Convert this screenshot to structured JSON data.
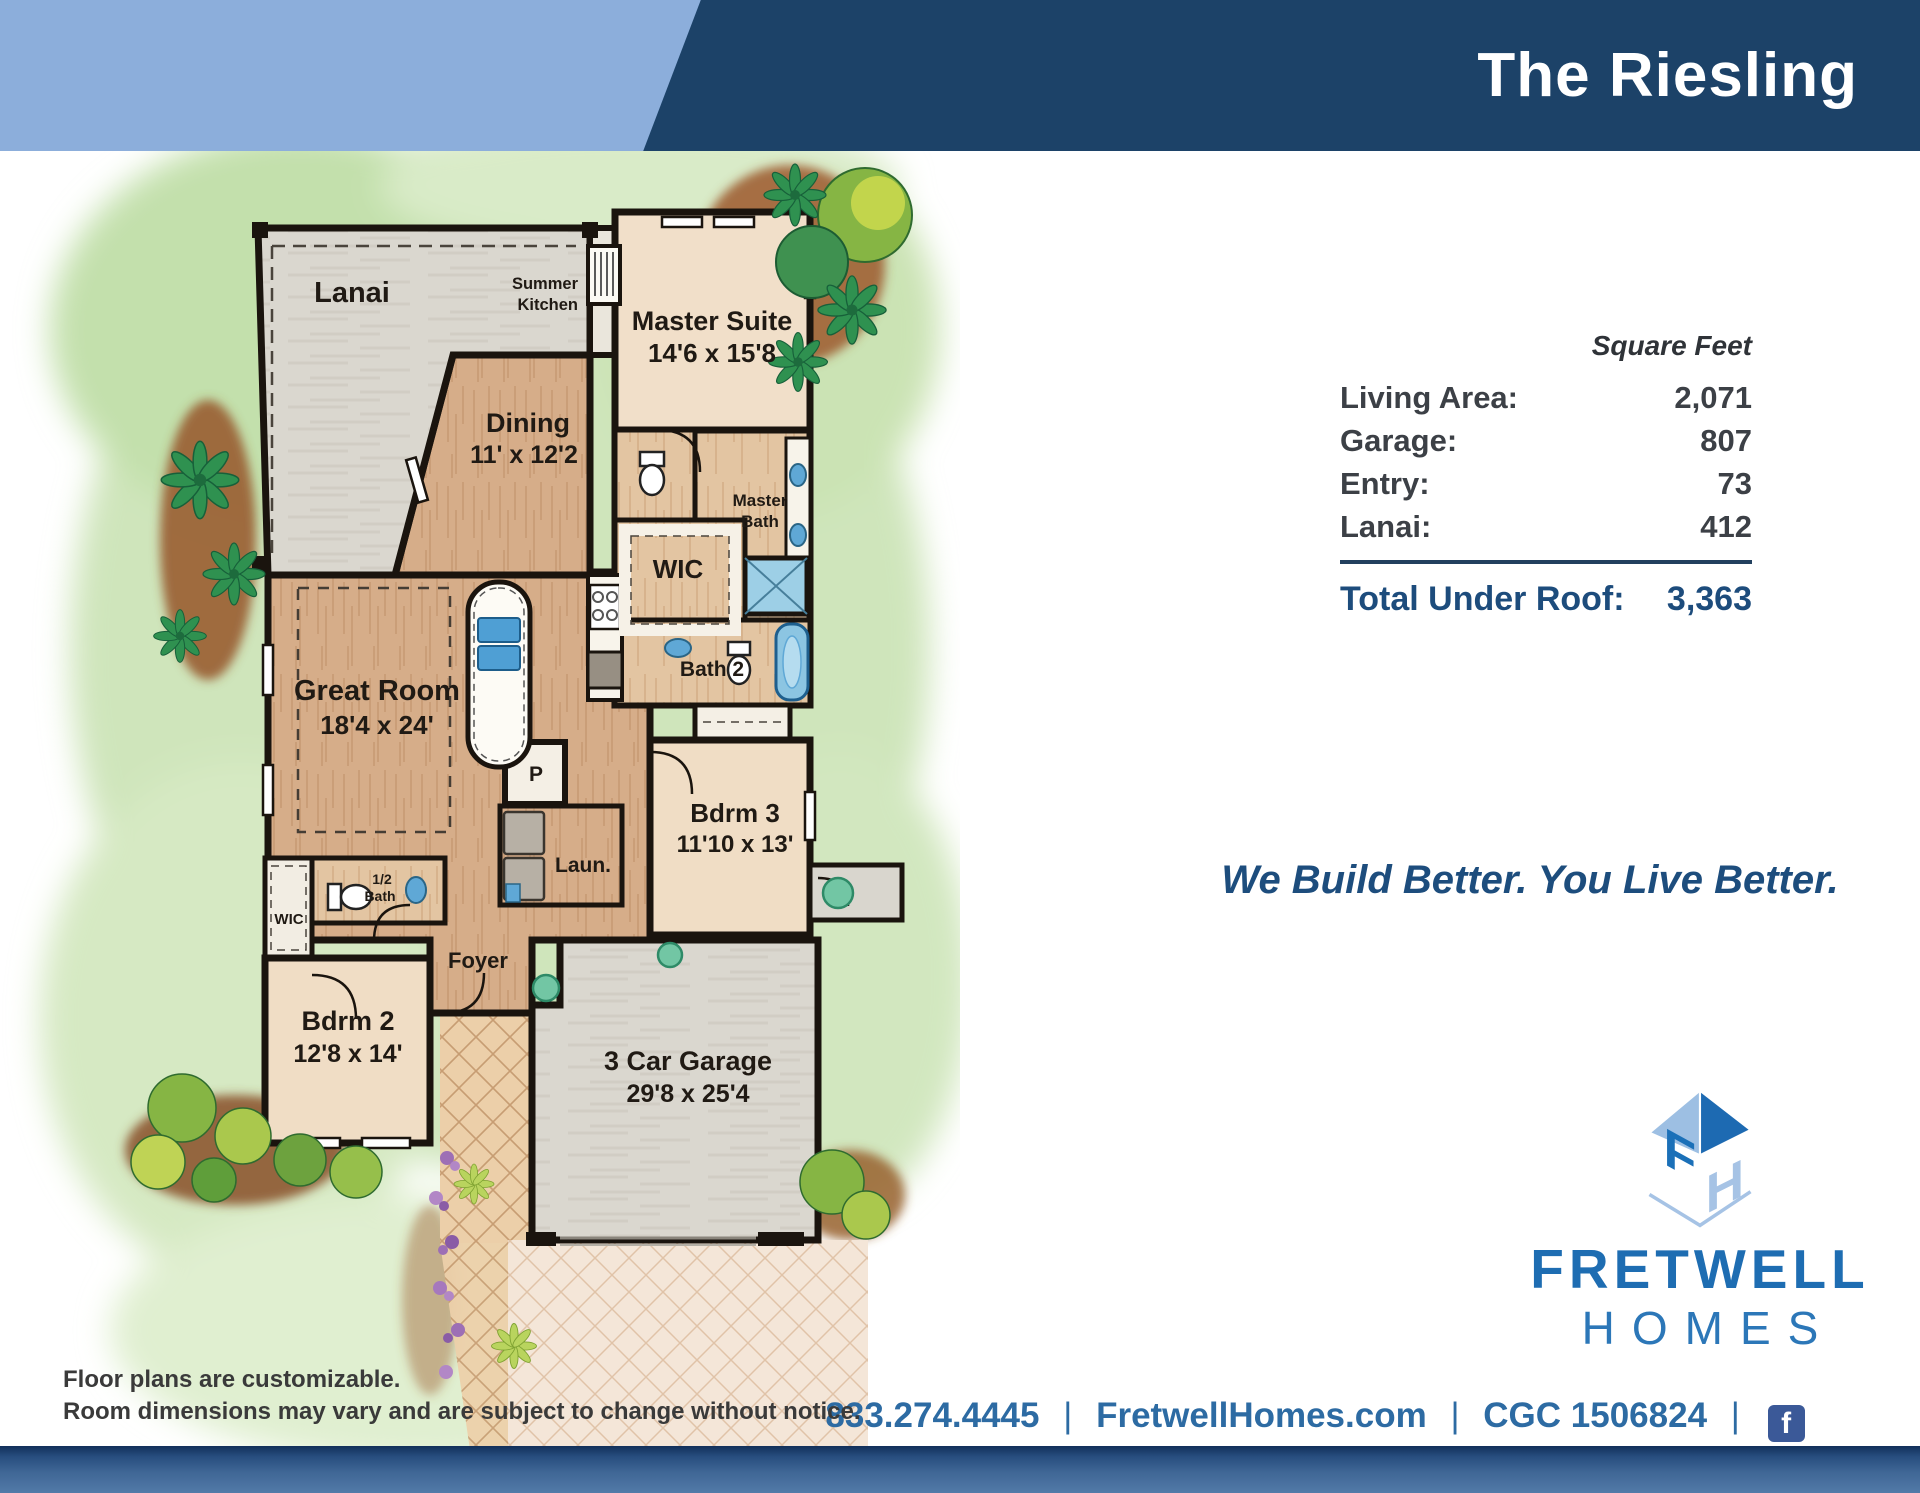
{
  "header": {
    "title": "The Riesling"
  },
  "floor_plan": {
    "rooms": {
      "lanai": {
        "label": "Lanai"
      },
      "summer_kitchen": {
        "line1": "Summer",
        "line2": "Kitchen"
      },
      "master_suite": {
        "label": "Master Suite",
        "dims": "14'6 x 15'8"
      },
      "dining": {
        "label": "Dining",
        "dims": "11' x 12'2"
      },
      "master_bath": {
        "line1": "Master",
        "line2": "Bath"
      },
      "wic_master": {
        "label": "WIC"
      },
      "bath2": {
        "label": "Bath 2"
      },
      "great_room": {
        "label": "Great Room",
        "dims": "18'4 x 24'"
      },
      "pantry": {
        "label": "P"
      },
      "laundry": {
        "label": "Laun."
      },
      "bdrm3": {
        "label": "Bdrm 3",
        "dims": "11'10 x 13'"
      },
      "half_bath": {
        "line1": "1/2",
        "line2": "Bath"
      },
      "wic_bdrm2": {
        "label": "WIC"
      },
      "foyer": {
        "label": "Foyer"
      },
      "bdrm2": {
        "label": "Bdrm 2",
        "dims": "12'8 x 14'"
      },
      "garage": {
        "label": "3 Car Garage",
        "dims": "29'8 x 25'4"
      }
    }
  },
  "stats": {
    "column_header": "Square Feet",
    "rows": [
      {
        "label": "Living Area:",
        "value": "2,071"
      },
      {
        "label": "Garage:",
        "value": "807"
      },
      {
        "label": "Entry:",
        "value": "73"
      },
      {
        "label": "Lanai:",
        "value": "412"
      }
    ],
    "total_label": "Total Under Roof:",
    "total_value": "3,363"
  },
  "tagline": "We Build Better. You Live Better.",
  "logo": {
    "name_line1": "FRETWELL",
    "name_line2": "HOMES",
    "monogram_f": "F",
    "monogram_h": "H"
  },
  "footer": {
    "phone": "833.274.4445",
    "separator": "|",
    "website": "FretwellHomes.com",
    "license": "CGC  1506824",
    "facebook_icon": "f"
  },
  "disclaimer": {
    "line1": "Floor plans are customizable.",
    "line2": "Room dimensions may vary and are subject to change without notice."
  },
  "colors": {
    "header_light_blue": "#8caedb",
    "header_navy": "#1c4268",
    "accent_navy": "#1d4d7d",
    "table_total_navy": "#1d4c7c",
    "footer_blue": "#2d6ba3",
    "logo_blue": "#1e6db2",
    "logo_light_blue": "#9dbfe3",
    "facebook_blue": "#3b5998",
    "watercolor_green": "#cfe5bb",
    "wood_floor": "#d6ad89",
    "carpet": "#f0ddc5",
    "concrete": "#dad7cf",
    "fixture_blue": "#8cc5e2",
    "accent_teal": "#72c6a4"
  }
}
